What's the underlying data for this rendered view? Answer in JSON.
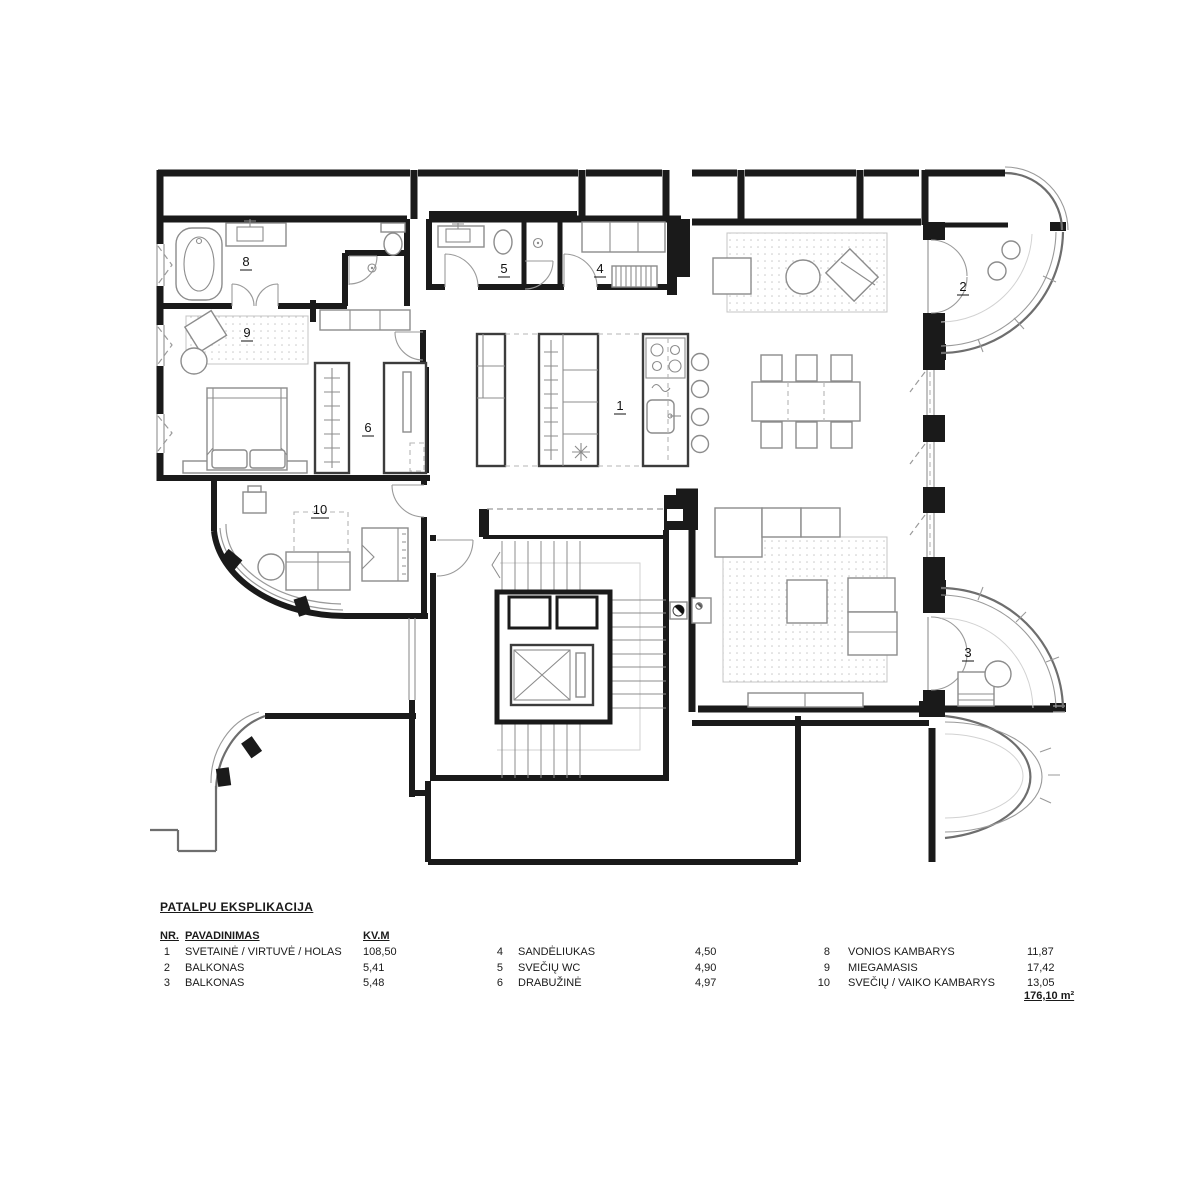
{
  "legend": {
    "title": "PATALPU EKSPLIKACIJA",
    "headers": {
      "nr": "NR.",
      "name": "PAVADINIMAS",
      "area": "KV.M"
    },
    "columns": [
      {
        "rows": [
          {
            "nr": "1",
            "name": "SVETAINĖ / VIRTUVĖ / HOLAS",
            "area": "108,50"
          },
          {
            "nr": "2",
            "name": "BALKONAS",
            "area": "5,41"
          },
          {
            "nr": "3",
            "name": "BALKONAS",
            "area": "5,48"
          }
        ]
      },
      {
        "rows": [
          {
            "nr": "4",
            "name": "SANDĖLIUKAS",
            "area": "4,50"
          },
          {
            "nr": "5",
            "name": "SVEČIŲ WC",
            "area": "4,90"
          },
          {
            "nr": "6",
            "name": "DRABUŽINĖ",
            "area": "4,97"
          }
        ]
      },
      {
        "rows": [
          {
            "nr": "8",
            "name": "VONIOS KAMBARYS",
            "area": "11,87"
          },
          {
            "nr": "9",
            "name": "MIEGAMASIS",
            "area": "17,42"
          },
          {
            "nr": "10",
            "name": "SVEČIŲ / VAIKO KAMBARYS",
            "area": "13,05"
          }
        ]
      }
    ],
    "total": "176,10 m²"
  },
  "plan": {
    "room_labels": [
      {
        "name": "living-kitchen-hall",
        "label": "1"
      },
      {
        "name": "balcony-2",
        "label": "2"
      },
      {
        "name": "balcony-3",
        "label": "3"
      },
      {
        "name": "storage",
        "label": "4"
      },
      {
        "name": "guest-wc",
        "label": "5"
      },
      {
        "name": "wardrobe",
        "label": "6"
      },
      {
        "name": "bathroom",
        "label": "8"
      },
      {
        "name": "bedroom",
        "label": "9"
      },
      {
        "name": "guest-child-room",
        "label": "10"
      }
    ],
    "colors": {
      "wall": "#1a1a1a",
      "furniture": "#8c8c8c",
      "background": "#ffffff"
    }
  }
}
